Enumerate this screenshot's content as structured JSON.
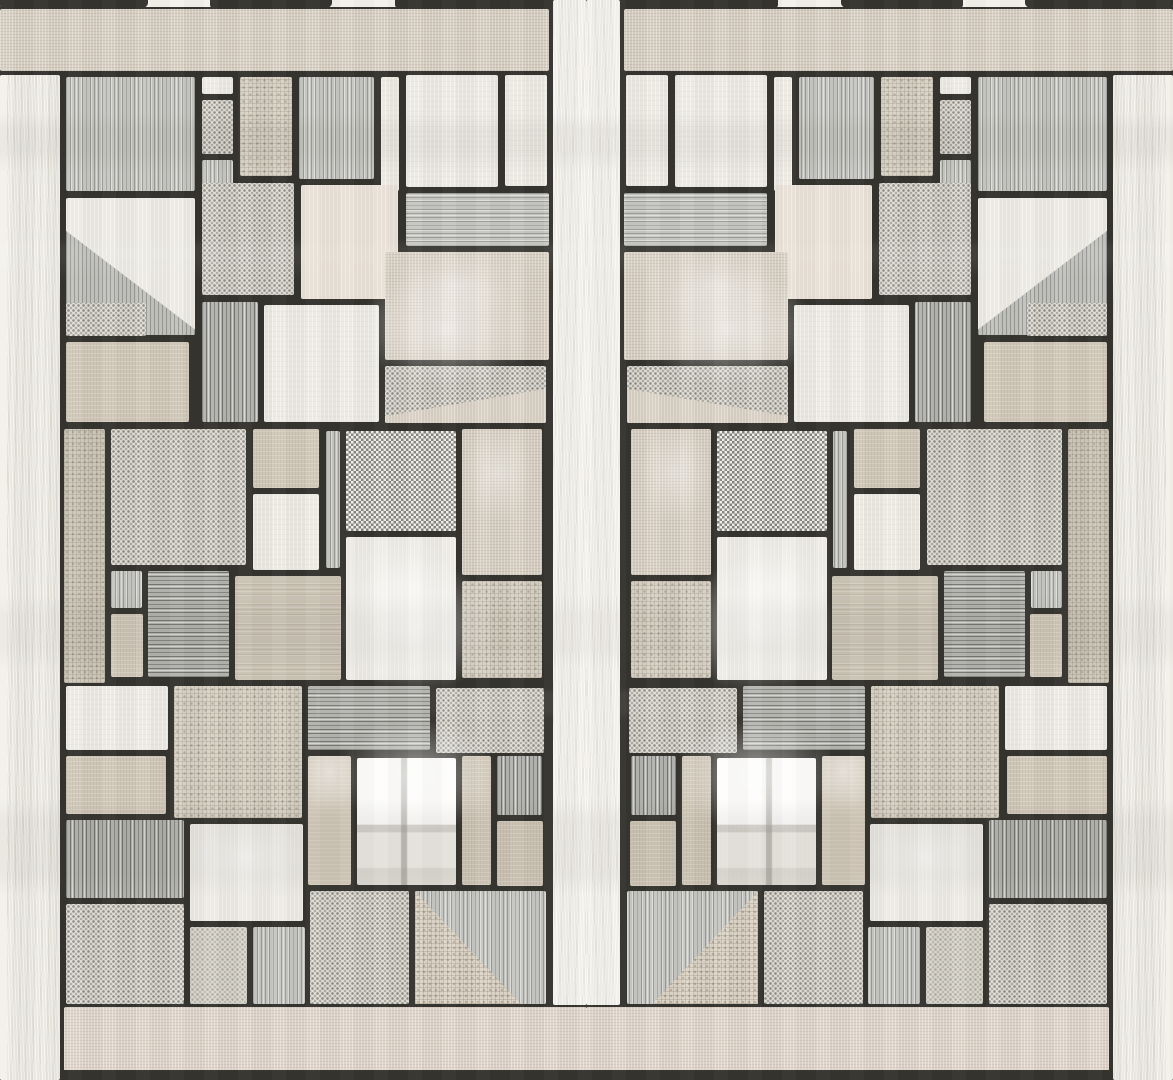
{
  "scene": {
    "type": "photograph",
    "subject": "sheer patchwork-print curtain fabric, backlit by a window",
    "style": "mirrored panel, Mondrian-like patch grid with black stitched seams",
    "symmetry": "vertical-mirror",
    "lighting": "daylight window glow behind sheer fabric"
  },
  "layout_info": {
    "width": 1173,
    "height": 1080,
    "half_width": 587,
    "mirror_axis_x": 586.5,
    "center_column_x": [
      551,
      623
    ],
    "left_edge_strip_width": 62,
    "top_band_height": 73,
    "bottom_band_y": 1005
  },
  "palette": {
    "seam": "#34332e",
    "linen": "#d7cfc2",
    "pink-linen": "#ded4c9",
    "gauze": "#eae8e0",
    "gauze-bright": "#f1efe9",
    "white": "#ebe9e2",
    "white-bright": "#f3f1ea",
    "white-warm": "#e8e0d6",
    "taupe": "#d1c8b9",
    "taupe-dark": "#cbc3b4",
    "burlap": "#d9d3c7",
    "burlap-gray": "#cfc9bc",
    "gray-stripe": "#c6c7c2",
    "gray-stripe-dark": "#b3b4af",
    "dot-bg": "#e1dfd7",
    "checker-bg": "#e7e5dd"
  },
  "texture_legend": {
    "seam": "black stitched seam / dark header tape",
    "linen": "beige linen weave",
    "pinklinen": "warm pink-beige linen (top and bottom bands)",
    "gauze": "off-white wavy gauze (edge strips)",
    "gauzeB": "bright white gauze (center column)",
    "white": "plain off-white cloth",
    "whiteflat": "flat bright white",
    "whitewarm": "warm pale cloth",
    "whiteGlow": "white cloth with window glow",
    "windowW": "white cloth with window panes showing through",
    "taupe": "plain taupe cloth",
    "taupe2": "darker taupe cloth",
    "taupeGlow": "taupe cloth with glow at top",
    "linenGlow": "beige linen with window glow",
    "burlap": "coarse speckled burlap weave",
    "burlap2": "gray-beige coarse weave",
    "triburlap": "burlap triangle patch",
    "gvert": "gray vertical pinstripe",
    "gvertD": "dark gray vertical pinstripe",
    "ghoriz": "gray horizontal pinstripe",
    "ghorizD": "dark gray horizontal pinstripe",
    "dot": "halftone dotted weave",
    "dotlight": "light dotted weave",
    "checker": "fine black-and-white checker weave",
    "diag": "white patch with diagonal seam over gray stripes",
    "dotdiag": "dotted patch with diagonal seam over beige"
  },
  "blocks": [
    [
      0,
      0,
      551,
      9,
      "whiteflat"
    ],
    [
      0,
      0,
      148,
      9,
      "seam"
    ],
    [
      210,
      0,
      122,
      9,
      "seam"
    ],
    [
      395,
      0,
      156,
      9,
      "seam"
    ],
    [
      0,
      7,
      551,
      66,
      "linen"
    ],
    [
      551,
      0,
      36,
      1007,
      "gauzeB"
    ],
    [
      0,
      73,
      62,
      1007,
      "gauze"
    ],
    [
      0,
      73,
      9,
      1007,
      "whiteflat"
    ],
    [
      62,
      1005,
      525,
      68,
      "pinklinen"
    ],
    [
      62,
      1070,
      525,
      10,
      "seam"
    ],
    [
      64,
      75,
      133,
      118,
      "gvert"
    ],
    [
      200,
      75,
      35,
      21,
      "white"
    ],
    [
      200,
      98,
      35,
      58,
      "dot"
    ],
    [
      200,
      158,
      35,
      35,
      "gvert"
    ],
    [
      238,
      75,
      56,
      103,
      "burlap"
    ],
    [
      297,
      75,
      79,
      106,
      "gvert"
    ],
    [
      379,
      75,
      22,
      118,
      "white"
    ],
    [
      404,
      73,
      96,
      116,
      "white"
    ],
    [
      503,
      73,
      46,
      115,
      "white"
    ],
    [
      404,
      191,
      147,
      57,
      "ghoriz"
    ],
    [
      200,
      181,
      96,
      116,
      "dot"
    ],
    [
      299,
      183,
      101,
      118,
      "whitewarm"
    ],
    [
      64,
      196,
      133,
      141,
      "diag"
    ],
    [
      64,
      301,
      84,
      37,
      "dot"
    ],
    [
      383,
      250,
      168,
      112,
      "linenGlow"
    ],
    [
      200,
      300,
      60,
      124,
      "gvertD"
    ],
    [
      262,
      303,
      119,
      121,
      "white"
    ],
    [
      64,
      340,
      127,
      84,
      "taupe"
    ],
    [
      383,
      364,
      165,
      61,
      "dotdiag"
    ],
    [
      62,
      427,
      45,
      258,
      "burlap2"
    ],
    [
      109,
      427,
      139,
      140,
      "dot"
    ],
    [
      251,
      427,
      70,
      63,
      "taupe"
    ],
    [
      251,
      492,
      70,
      80,
      "white"
    ],
    [
      324,
      429,
      18,
      141,
      "gvert"
    ],
    [
      344,
      429,
      114,
      104,
      "checker"
    ],
    [
      460,
      427,
      84,
      150,
      "linenGlow"
    ],
    [
      344,
      535,
      114,
      147,
      "whiteGlow"
    ],
    [
      109,
      569,
      35,
      41,
      "gvert"
    ],
    [
      146,
      569,
      85,
      110,
      "ghorizD"
    ],
    [
      109,
      612,
      36,
      67,
      "taupe"
    ],
    [
      233,
      574,
      110,
      108,
      "taupe2"
    ],
    [
      460,
      579,
      84,
      101,
      "burlap"
    ],
    [
      64,
      684,
      106,
      68,
      "white"
    ],
    [
      172,
      684,
      132,
      136,
      "burlap"
    ],
    [
      306,
      684,
      126,
      68,
      "ghorizD"
    ],
    [
      434,
      686,
      112,
      69,
      "dot"
    ],
    [
      64,
      754,
      104,
      62,
      "taupe"
    ],
    [
      64,
      818,
      122,
      82,
      "gvertD"
    ],
    [
      64,
      902,
      122,
      104,
      "dot"
    ],
    [
      188,
      822,
      117,
      101,
      "whiteGlow"
    ],
    [
      188,
      925,
      61,
      81,
      "dotlight"
    ],
    [
      251,
      925,
      56,
      81,
      "gvert"
    ],
    [
      306,
      754,
      47,
      133,
      "taupeGlow"
    ],
    [
      355,
      756,
      103,
      131,
      "windowW"
    ],
    [
      460,
      754,
      33,
      133,
      "taupe"
    ],
    [
      495,
      754,
      49,
      63,
      "gvertD"
    ],
    [
      495,
      819,
      50,
      69,
      "taupe"
    ],
    [
      308,
      889,
      103,
      117,
      "dot"
    ],
    [
      413,
      889,
      135,
      117,
      "gvert"
    ],
    [
      413,
      889,
      110,
      117,
      "triburlap"
    ]
  ],
  "windows": [
    {
      "kind": "upper",
      "x": 338,
      "y": 256,
      "w": 215,
      "h": 172
    },
    {
      "kind": "lower",
      "x": 316,
      "y": 552,
      "w": 239,
      "h": 338
    }
  ]
}
